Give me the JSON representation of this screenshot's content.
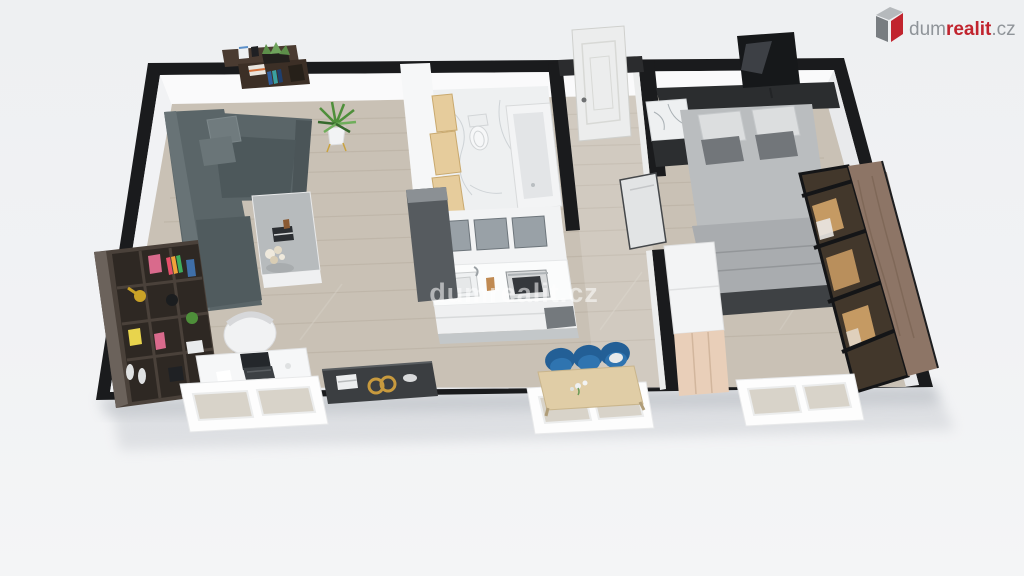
{
  "brand": {
    "name": "dumrealit.cz",
    "segments": {
      "prefix": "dum",
      "accent": "realit",
      "suffix": ".cz"
    },
    "colors": {
      "gray": "#8f9499",
      "red": "#c1242e",
      "icon_top": "#b5b9bc",
      "icon_front": "#787d81"
    },
    "icon": "building-cube-icon"
  },
  "watermark": {
    "text": "dumrealit.cz",
    "color": "#ffffff",
    "opacity": "0.55"
  },
  "palette": {
    "background": "#f0f1f3",
    "wall": "#1a1b1d",
    "wall_face": "#fafafb",
    "floor_wood": "#c9c1b5",
    "floor_plank": "#b3aa9c",
    "marble": "#eef0f1",
    "sofa": "#5a6568",
    "sofa_dark": "#4d585b",
    "pillow_gray": "#72767a",
    "pillow_white": "#dcdedf",
    "bookshelf": "#4a413a",
    "bookshelf_cell": "#2e2823",
    "desk": "#f6f7f8",
    "laptop": "#24272b",
    "sideboard": "#3b3e41",
    "gold": "#c89a3e",
    "kitchen": "#f2f3f4",
    "kitchen_glass": "#99a1a7",
    "counter": "#fbfcfc",
    "bath_wood": "#e6cc9c",
    "tub": "#f3f4f5",
    "door": "#eceded",
    "bed": "#babdbf",
    "bed_fold": "#a9acaf",
    "headboard": "#2b2d2f",
    "tv": "#16181a",
    "dresser": "#f3f4f5",
    "dresser_front": "#e9cfb9",
    "wardrobe_wood": "#8d7566",
    "wardrobe_glass": "#42372b",
    "wardrobe_warm": "#c59a63",
    "dining_table": "#e0cda6",
    "chair_blue": "#2b6da8",
    "window_frame": "#fdfdfd",
    "window_pane": "#d8d3c9",
    "plant_green": "#4e8f3a"
  }
}
